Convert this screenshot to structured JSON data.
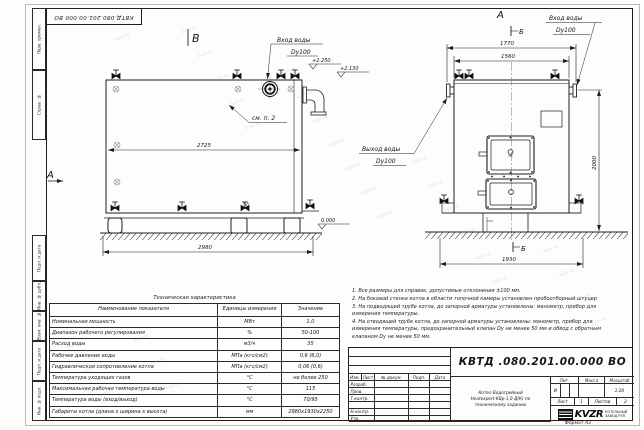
{
  "sheet": {
    "stamp_top": "КВТД.080.201.00.000 ВО",
    "format_note": "Формат  А3"
  },
  "frame_labels": {
    "top": [
      "Перв. примен.",
      "Справ. №"
    ],
    "bottom": [
      "Подп. и дата",
      "Инв. № дубл.",
      "Взам. инв. №",
      "Подп. и дата",
      "Инв. № подл."
    ]
  },
  "views": {
    "side": {
      "view_marker": "В",
      "left_view_marker": "А",
      "inlet_label": "Вход воды",
      "inlet_dn": "Dy100",
      "see_note": "см. п. 2",
      "elev_top": "+2.250",
      "elev_branch": "+2.130",
      "elev_zero": "0.000",
      "dim_inner": "2725",
      "dim_overall": "2980"
    },
    "front": {
      "view_marker": "А",
      "section_marker_top": "Б",
      "section_marker_bottom": "Б",
      "inlet_label": "Вход воды",
      "inlet_dn": "Dy100",
      "outlet_label": "Выход воды",
      "outlet_dn": "Dy100",
      "dim_flanges": "1770",
      "dim_body": "1560",
      "dim_height": "2000",
      "dim_base": "1930"
    }
  },
  "notes": [
    "1. Все размеры для справок, допустимые отклонения ±100 мм.",
    "2. На боковой стенке котла в области топочной камеры установлен пробоотборный штуцер",
    "3. На подводящей трубе котла, до запорной арматуры установлены: манометр, прибор для измерения температуры.",
    "4. На отводящей трубе котла, до запорной арматуры установлены: манометр, прибор для измерения температуры, предохранительный клапан Dу не менее 50 мм и обвод с обратным клапаном Dу не менее 50 мм."
  ],
  "spec_table": {
    "title": "Техническая характеристика",
    "headers": [
      "Наименование показателя",
      "Единицы измерения",
      "Значение"
    ],
    "rows": [
      {
        "name": "Номинальная мощность",
        "unit": "МВт",
        "value": "1,0"
      },
      {
        "name": "Диапазон рабочего регулирования",
        "unit": "%",
        "value": "50-100"
      },
      {
        "name": "Расход воды",
        "unit": "м3/ч",
        "value": "35"
      },
      {
        "name": "Рабочее давление воды",
        "unit": "МПа (кгс/см2)",
        "value": "0,6 (6,0)"
      },
      {
        "name": "Гидравлическое сопротивление котла",
        "unit": "МПа (кгс/см2)",
        "value": "0,06 (0,6)"
      },
      {
        "name": "Температура уходящих газов",
        "unit": "°С",
        "value": "не более 250"
      },
      {
        "name": "Максимальная рабочая температура воды",
        "unit": "°С",
        "value": "115"
      },
      {
        "name": "Температура воды (вход/выход)",
        "unit": "°С",
        "value": "70/95"
      },
      {
        "name": "Габариты котла (длина х ширина х высота)",
        "unit": "мм",
        "value": "2980х1930х2250"
      }
    ]
  },
  "title_block": {
    "doc_number": "КВТД .080.201.00.000  ВО",
    "product_name": [
      "Котел Водогрейный",
      "Heatexpert-КВр-1,0-Д(К) по",
      "техническому заданию"
    ],
    "change_cols": [
      "Изм.",
      "Лист",
      "№ докум.",
      "Подп.",
      "Дата"
    ],
    "sign_rows": [
      "Разраб.",
      "Пров.",
      "Т.контр.",
      "Н.контр.",
      "Утв."
    ],
    "lit_label": "Лит.",
    "mass_label": "Масса",
    "scale_label": "Масштаб",
    "lit_value": "И",
    "scale_value": "1:20",
    "sheet_label": "Лист",
    "sheet_value": "1",
    "sheets_label": "Листов",
    "sheets_value": "2",
    "company_logo": "KVZR",
    "company_line1": "КОТЕЛЬНЫЙ",
    "company_line2": "ЗАВОД РЭП"
  },
  "watermark": {
    "text": "kvzr.ru"
  },
  "colors": {
    "line": "#1e1e1e",
    "thin": "#555555"
  }
}
